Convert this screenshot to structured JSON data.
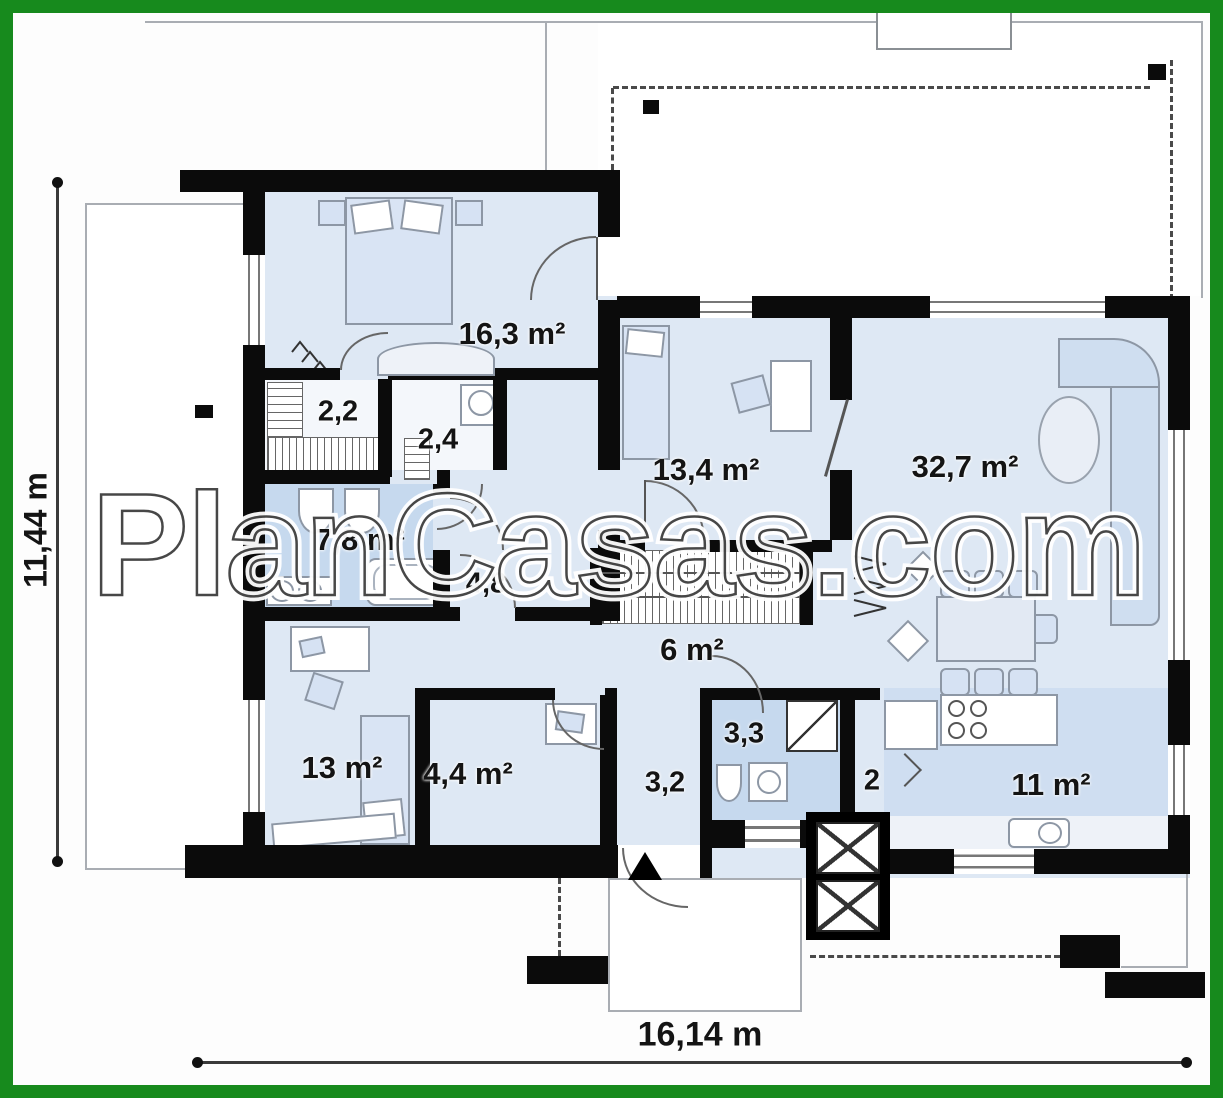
{
  "title": "House floor plan",
  "watermark": "PlanCasas.com",
  "dimensions": {
    "height_label": "11,44 m",
    "width_label": "16,14 m"
  },
  "rooms": {
    "bedroom_main": {
      "area_label": "16,3 m²"
    },
    "closet": {
      "area_label": "2,2"
    },
    "wc": {
      "area_label": "2,4"
    },
    "bathroom_main": {
      "area_label": "7,8 m²"
    },
    "hall_bedrooms": {
      "area_label": "4,8"
    },
    "bedroom_2": {
      "area_label": "13,4 m²"
    },
    "living_room": {
      "area_label": "32,7 m²"
    },
    "hall_central": {
      "area_label": "6 m²"
    },
    "bedroom_3": {
      "area_label": "13 m²"
    },
    "utility": {
      "area_label": "4,4 m²"
    },
    "entry_hall": {
      "area_label": "3,2"
    },
    "bathroom_2": {
      "area_label": "3,3"
    },
    "storage": {
      "area_label": "2"
    },
    "kitchen": {
      "area_label": "11 m²"
    }
  },
  "colors": {
    "frame_green": "#178a1d",
    "wall_black": "#0b0b0b",
    "floor_light": "#dee8f4",
    "floor_wet": "#c6d9ee",
    "kitchen_band": "#cfdef1"
  }
}
